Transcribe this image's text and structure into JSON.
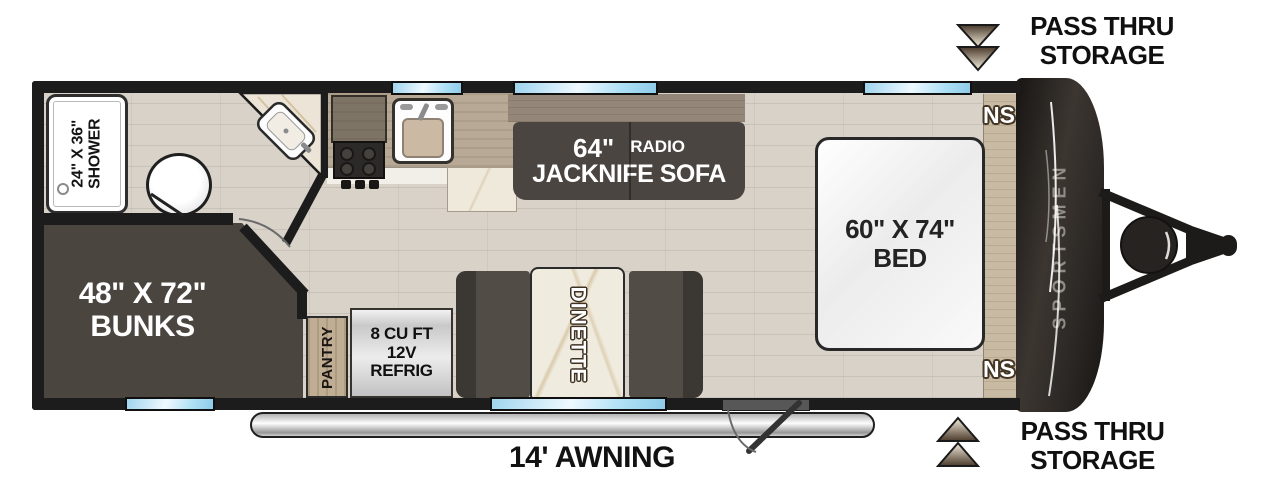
{
  "floorplan": {
    "brand": "SPORTSMEN",
    "shower": {
      "size": "24\" X 36\"",
      "name": "SHOWER"
    },
    "bunks": {
      "size": "48\" X 72\"",
      "name": "BUNKS"
    },
    "sofa": {
      "size": "64\"",
      "radio": "RADIO",
      "name": "JACKNIFE SOFA"
    },
    "bed": {
      "size": "60\" X 74\"",
      "name": "BED"
    },
    "dinette": {
      "name": "DINETTE"
    },
    "pantry": {
      "name": "PANTRY"
    },
    "refrigerator": {
      "line1": "8 CU FT",
      "line2": "12V",
      "line3": "REFRIG"
    },
    "awning": {
      "label": "14' AWNING"
    },
    "nightstand_top": "NS",
    "nightstand_bottom": "NS",
    "pass_thru_top": {
      "line1": "PASS THRU",
      "line2": "STORAGE"
    },
    "pass_thru_bottom": {
      "line1": "PASS THRU",
      "line2": "STORAGE"
    }
  },
  "colors": {
    "wall": "#1c1c1c",
    "floor": "#d8d2c9",
    "window_blue": "#aee0f5",
    "furniture_dark": "#4b4540",
    "wood_counter": "#b7a995",
    "marble": "#efe9dc",
    "front_cap": "#2b2724",
    "awning_silver": "#c9c9c9",
    "arrow_cream": "#f2e8d6",
    "arrow_brown": "#5a4634",
    "brand_text": "#918c85",
    "label_white": "#ffffff",
    "label_black": "#101010"
  }
}
